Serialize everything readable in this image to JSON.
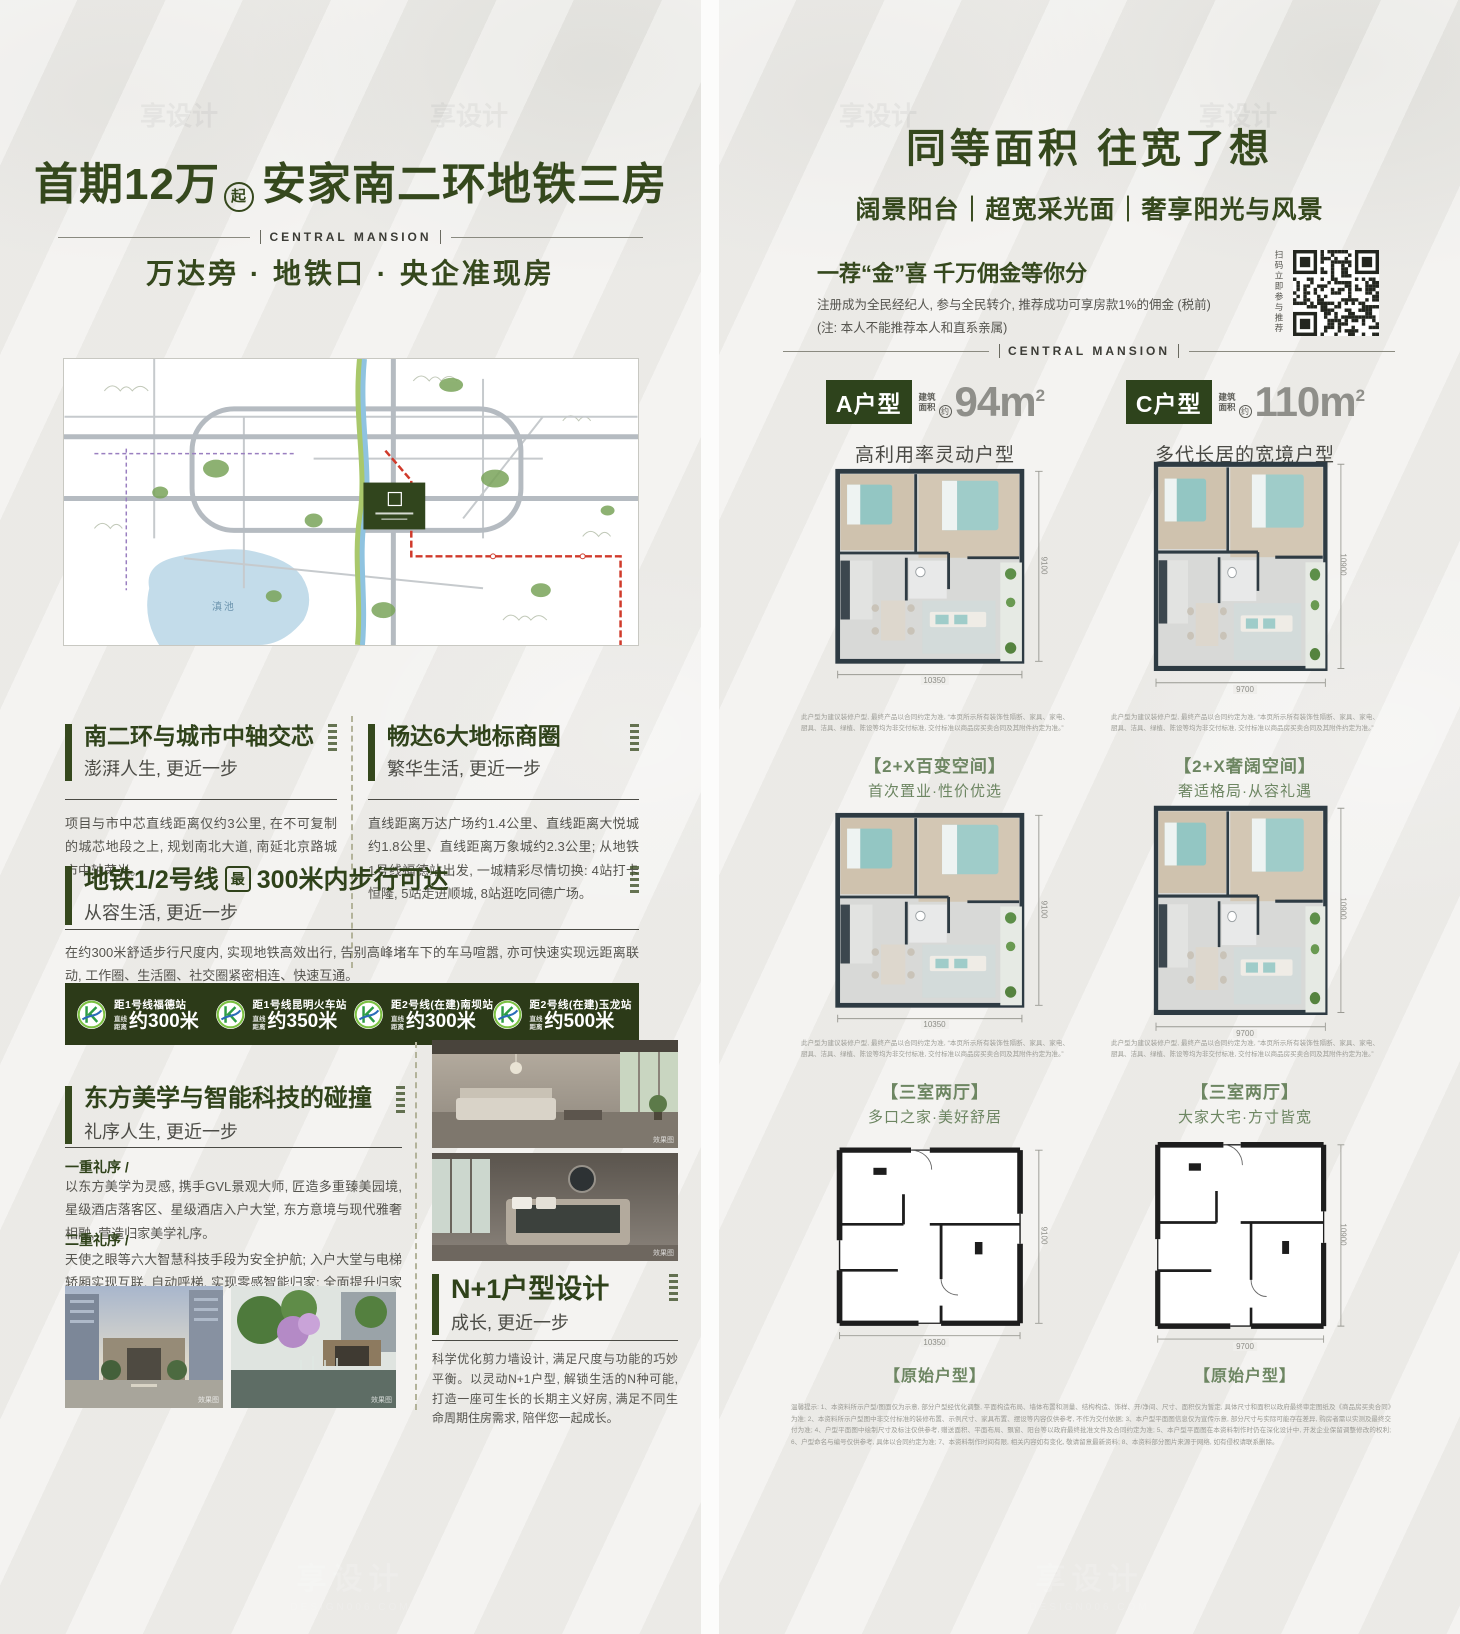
{
  "brand": {
    "en": "CENTRAL MANSION"
  },
  "watermark": {
    "name": "享设计",
    "site": "DESIGN006.COM"
  },
  "left": {
    "title1": "首期12万",
    "title_badge": "起",
    "title2": "安家南二环地铁三房",
    "tagline": "万达旁 · 地铁口 · 央企准现房",
    "map": {
      "lake": "滇池"
    },
    "sec1": {
      "title": "南二环与城市中轴交芯",
      "sub": "澎湃人生, 更近一步",
      "body": "项目与市中芯直线距离仅约3公里, 在不可复制的城芯地段之上, 规划南北大道, 南延北京路城市中轴荣光。"
    },
    "sec2": {
      "title": "畅达6大地标商圈",
      "sub": "繁华生活, 更近一步",
      "body": "直线距离万达广场约1.4公里、直线距离大悦城约1.8公里、直线距离万象城约2.3公里; 从地铁1号线福德站出发, 一城精彩尽情切换: 4站打卡恒隆, 5站走进顺城, 8站逛吃同德广场。"
    },
    "sec3": {
      "title_a": "地铁1/2号线",
      "badge": "最",
      "title_b": "300米内步行可达",
      "sub": "从容生活, 更近一步",
      "body": "在约300米舒适步行尺度内, 实现地铁高效出行, 告别高峰堵车下的车马喧嚣, 亦可快速实现远距离联动, 工作圈、生活圈、社交圈紧密相连、快速互通。"
    },
    "metro": {
      "prefix1": "直线",
      "prefix2": "距离",
      "items": [
        {
          "station": "距1号线福德站",
          "dist": "约300米"
        },
        {
          "station": "距1号线昆明火车站",
          "dist": "约350米"
        },
        {
          "station": "距2号线(在建)南坝站",
          "dist": "约300米"
        },
        {
          "station": "距2号线(在建)玉龙站",
          "dist": "约500米"
        }
      ]
    },
    "sec4": {
      "title": "东方美学与智能科技的碰撞",
      "sub": "礼序人生, 更近一步",
      "p1_label": "一重礼序 /",
      "p1": "以东方美学为灵感, 携手GVL景观大师, 匠造多重臻美园境, 星级酒店落客区、星级酒店入户大堂, 东方意境与现代雅奢相融, 营造归家美学礼序。",
      "p2_label": "二重礼序 /",
      "p2": "天使之眼等六大智慧科技手段为安全护航; 入户大堂与电梯轿厢实现互联, 自动呼梯, 实现零感智能归家; 全面提升归家礼序的仪式感。"
    },
    "sec5": {
      "title": "N+1户型设计",
      "sub": "成长, 更近一步",
      "body": "科学优化剪力墙设计, 满足尺度与功能的巧妙平衡。以灵动N+1户型, 解锁生活的N种可能, 打造一座可生长的长期主义好房, 满足不同生命周期住房需求, 陪伴您一起成长。"
    },
    "photo_caption": "效果图"
  },
  "right": {
    "title": "同等面积  往宽了想",
    "subtitle": "阔景阳台｜超宽采光面｜奢享阳光与风景",
    "promo": {
      "headline": "一荐“金”喜  千万佣金等你分",
      "line1": "注册成为全民经纪人, 参与全民转介, 推荐成功可享房款1%的佣金 (税前)",
      "line2": "(注: 本人不能推荐本人和直系亲属)",
      "qr_label": "扫码立即参与推荐"
    },
    "area_label1": "建筑",
    "area_label2": "面积",
    "area_approx": "约",
    "area_sup": "2",
    "units": [
      {
        "name": "A户型",
        "area": "94m",
        "desc": "高利用率灵动户型",
        "dim_w": "10350",
        "dim_h": "9100",
        "row1_tag": "【2+X百变空间】",
        "row1_line": "首次置业·性价优选",
        "row2_tag": "【三室两厅】",
        "row2_line": "多口之家·美好舒居",
        "row3_tag": "【原始户型】"
      },
      {
        "name": "C户型",
        "area": "110m",
        "desc": "多代长居的宽境户型",
        "dim_w": "9700",
        "dim_h": "10900",
        "row1_tag": "【2+X奢阔空间】",
        "row1_line": "奢适格局·从容礼遇",
        "row2_tag": "【三室两厅】",
        "row2_line": "大家大宅·方寸皆宽",
        "row3_tag": "【原始户型】"
      }
    ],
    "plan_note": "此户型为建议装修户型, 最终产品以合同约定为准, “本页所示所有装饰性隔断、家具、家电、厨具、洁具、绿植、陈设等均为非交付标准, 交付标准以商品房买卖合同及其附件约定为准。”",
    "disclaimer": "温馨提示: 1、本资料所示户型/图面仅为示意, 部分户型经优化调整, 平面构造布局、墙体布置和测量、结构构造、饰样、开/净间、尺寸、面积仅为暂定, 具体尺寸和面积以政府最终审定图纸及《商品房买卖合同》为准; 2、本资料所示户型图中非交付标准的装修布置、示例尺寸、家具布置、摆设等内容仅供参考, 不作为交付依据; 3、本户型平面图信息仅为宣传示意, 部分尺寸与实际可能存在差异, 购房者需以实测及最终交付为准; 4、户型平面图中绘制尺寸及标注仅供参考, 赠送面积、平面布局、飘窗、阳台等以政府最终批准文件及合同约定为准; 5、本户型平面图在本资料制作时仍在深化设计中, 开发企业保留调整修改的权利; 6、户型命名与编号仅供参考, 具体以合同约定为准; 7、本资料制作时间有限, 相关内容如有变化, 敬请留意最新资料; 8、本资料部分图片来源于网络, 如有侵权请联系删除。"
  }
}
